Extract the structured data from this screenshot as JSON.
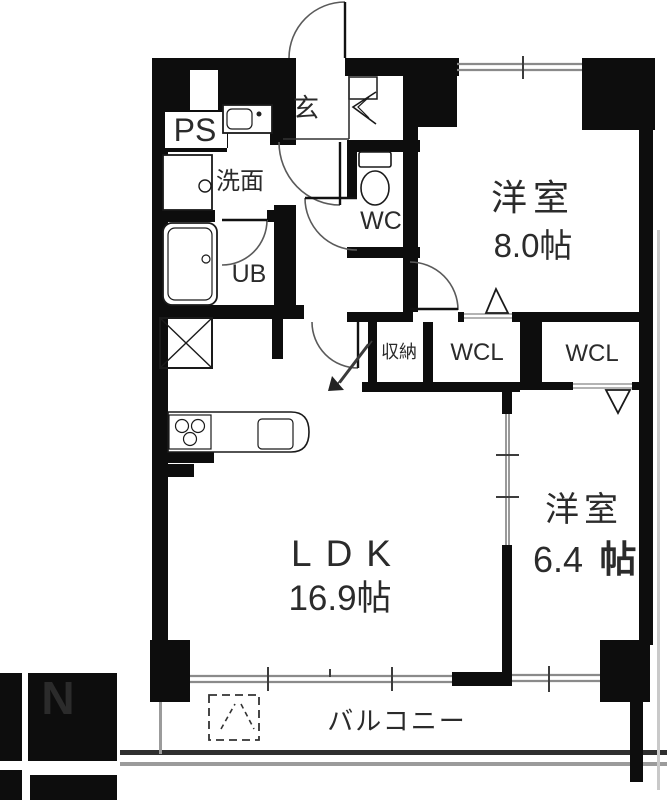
{
  "floorplan": {
    "rooms": {
      "pipe_space": {
        "label": "PS"
      },
      "entrance": {
        "label": "玄"
      },
      "washroom": {
        "label": "洗面"
      },
      "toilet": {
        "label": "WC"
      },
      "bath": {
        "label": "UB"
      },
      "storage": {
        "label": "収納"
      },
      "closet1": {
        "label": "WCL"
      },
      "closet2": {
        "label": "WCL"
      },
      "western8": {
        "name": "洋室",
        "size": "8.0帖"
      },
      "western6": {
        "name": "洋室",
        "size_number": "6.4",
        "size_unit": "帖"
      },
      "ldk": {
        "name": "LDK",
        "size": "16.9帖"
      },
      "balcony": {
        "label": "バルコニー"
      }
    },
    "compass": {
      "label": "N"
    },
    "colors": {
      "wall": "#0d0d0d",
      "window_line": "#8a8a8a",
      "door_arc": "#555555",
      "balcony_text": "#555555"
    }
  }
}
